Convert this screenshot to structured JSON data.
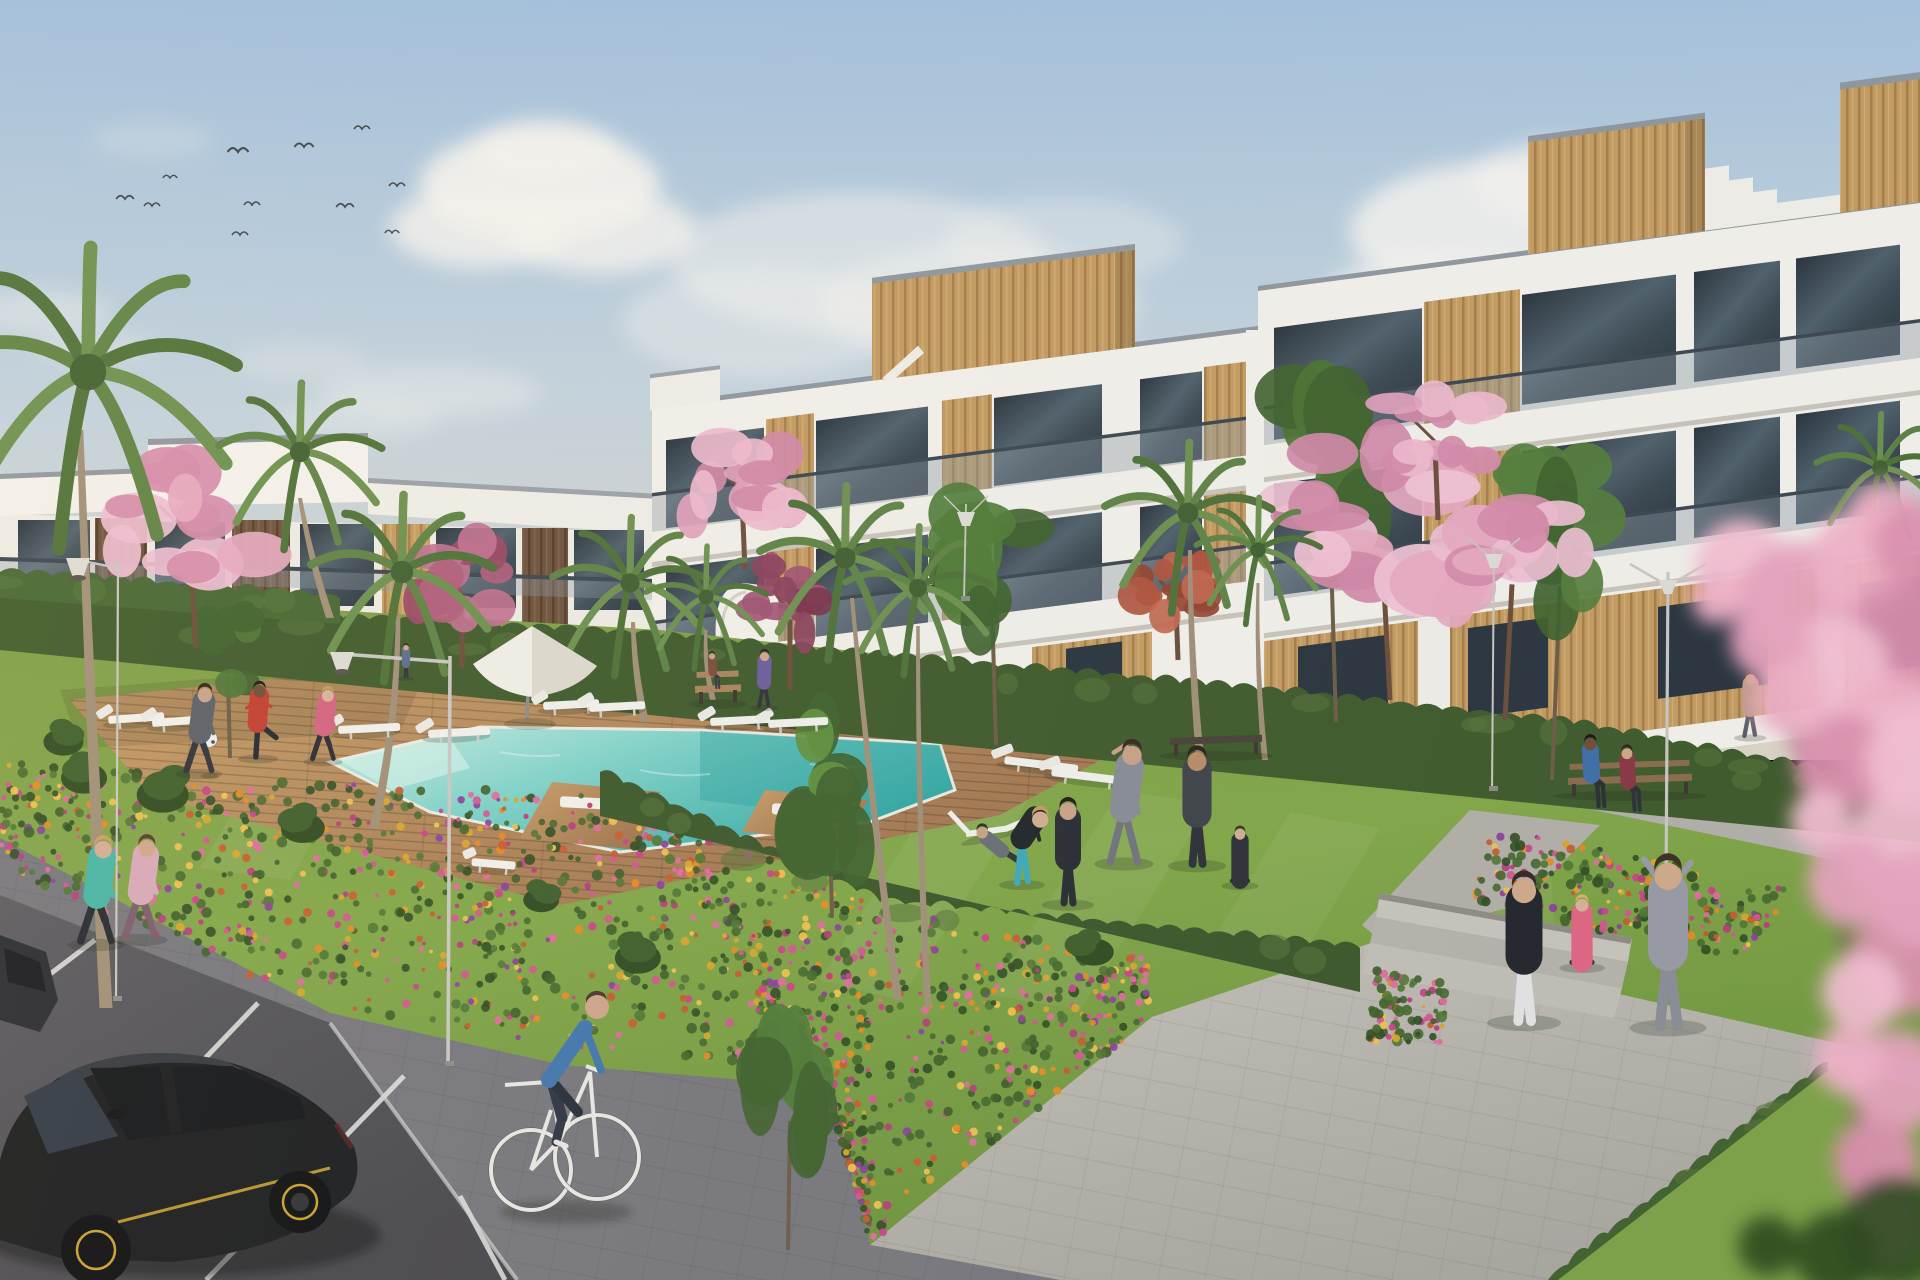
{
  "meta": {
    "scene": "residential-complex-3d-render",
    "style": "architectural visualization, golden afternoon light"
  },
  "labels": {
    "scene": "3D render of a modern white apartment complex with communal pool garden",
    "sky": "pale blue sky with soft clouds and a flock of birds",
    "buildings": "white three-storey apartments with wood cladding and glass balconies",
    "pool": "turquoise swimming pool with wooden deck and sun loungers",
    "lawn": "bright green communal lawn with people exercising",
    "road": "asphalt parking strip with black hatchback car",
    "foreground": "out-of-focus pink blossom branch"
  },
  "palette": {
    "sky_top": "#9dbddc",
    "sky_mid": "#c3d2dc",
    "sky_horizon": "#ddd5c6",
    "cloud": "#f7f4ef",
    "building_white": "#f4f1ea",
    "building_shadow": "#d9d5cc",
    "window_glass": "#31404c",
    "wood_gold": "#c49a5e",
    "wood_dark": "#5f4734",
    "balcony_glass": "#8b98a2",
    "hedge_green": "#3f5a28",
    "lawn_light": "#8fae4d",
    "lawn_dark": "#6d9339",
    "pool_light": "#bfe9df",
    "pool_deep": "#2fa8a4",
    "deck_wood": "#b98a58",
    "path_gray": "#b7b3aa",
    "sidewalk_gray": "#76757a",
    "road_gray": "#4e4d52",
    "flower_orange": "#e8891f",
    "flower_magenta": "#cc3f88",
    "flower_purple": "#8a3f9a",
    "flower_gold": "#d9a42a",
    "blossom_pink": "#e8a8bf",
    "car_black": "#17181a",
    "car_accent_yellow": "#c9a22c"
  },
  "clouds": [
    [
      540,
      185,
      120,
      55,
      0.9
    ],
    [
      480,
      228,
      90,
      40,
      0.8
    ],
    [
      602,
      232,
      95,
      42,
      0.8
    ],
    [
      545,
      152,
      70,
      32,
      0.7
    ],
    [
      860,
      262,
      190,
      70,
      0.5
    ],
    [
      980,
      305,
      160,
      60,
      0.45
    ],
    [
      762,
      322,
      140,
      55,
      0.4
    ],
    [
      1062,
      242,
      120,
      45,
      0.35
    ],
    [
      1500,
      232,
      150,
      70,
      0.85
    ],
    [
      1432,
      302,
      110,
      50,
      0.7
    ],
    [
      1562,
      182,
      90,
      40,
      0.75
    ],
    [
      430,
      392,
      110,
      26,
      0.38
    ],
    [
      358,
      420,
      82,
      20,
      0.3
    ],
    [
      300,
      362,
      70,
      18,
      0.26
    ],
    [
      40,
      312,
      70,
      22,
      0.38
    ],
    [
      92,
      346,
      60,
      16,
      0.3
    ],
    [
      152,
      140,
      62,
      18,
      0.22
    ],
    [
      1180,
      380,
      120,
      28,
      0.25
    ]
  ],
  "birds": [
    [
      125,
      199,
      1.1
    ],
    [
      152,
      206,
      1.0
    ],
    [
      170,
      178,
      0.9
    ],
    [
      238,
      152,
      1.3
    ],
    [
      240,
      235,
      1.0
    ],
    [
      252,
      205,
      1.0
    ],
    [
      304,
      147,
      1.2
    ],
    [
      345,
      207,
      1.1
    ],
    [
      362,
      129,
      1.0
    ],
    [
      397,
      186,
      1.0
    ],
    [
      392,
      233,
      0.9
    ]
  ],
  "mow_stripes": [
    [
      [
        950,
        770
      ],
      [
        1040,
        782
      ],
      [
        900,
        1000
      ],
      [
        820,
        980
      ]
    ],
    [
      [
        1120,
        790
      ],
      [
        1210,
        804
      ],
      [
        1080,
        1010
      ],
      [
        990,
        995
      ]
    ],
    [
      [
        1290,
        812
      ],
      [
        1380,
        828
      ],
      [
        1300,
        960
      ],
      [
        1210,
        945
      ]
    ],
    [
      [
        1460,
        840
      ],
      [
        1550,
        858
      ],
      [
        1560,
        1010
      ],
      [
        1470,
        995
      ]
    ],
    [
      [
        240,
        800
      ],
      [
        330,
        812
      ],
      [
        290,
        880
      ],
      [
        200,
        868
      ]
    ]
  ],
  "beds": [
    {
      "q": [
        [
          0,
          762
        ],
        [
          320,
          782
        ],
        [
          330,
          1010
        ],
        [
          0,
          868
        ]
      ],
      "n": 300
    },
    {
      "q": [
        [
          320,
          782
        ],
        [
          620,
          795
        ],
        [
          830,
          1086
        ],
        [
          330,
          1010
        ]
      ],
      "n": 460
    },
    {
      "q": [
        [
          620,
          795
        ],
        [
          880,
          905
        ],
        [
          870,
          1243
        ],
        [
          830,
          1086
        ]
      ],
      "n": 420
    },
    {
      "q": [
        [
          880,
          905
        ],
        [
          1150,
          958
        ],
        [
          1152,
          1017
        ],
        [
          870,
          1243
        ]
      ],
      "n": 330
    },
    {
      "q": [
        [
          1376,
          970
        ],
        [
          1452,
          985
        ],
        [
          1438,
          1055
        ],
        [
          1366,
          1040
        ]
      ],
      "n": 90
    },
    {
      "q": [
        [
          1490,
          826
        ],
        [
          1802,
          892
        ],
        [
          1742,
          960
        ],
        [
          1468,
          902
        ]
      ],
      "n": 240
    }
  ],
  "flower_colors": [
    "#e8891f",
    "#d9a42a",
    "#cc3f88",
    "#e06a9a",
    "#8a3f9a",
    "#c85a2a",
    "#f0c04a",
    "#b83a78",
    "#d4548e"
  ],
  "leaf_colors": [
    "#2e4a1e",
    "#3c5c26",
    "#4e7430",
    "#446628"
  ],
  "hedges": [
    {
      "pts": [
        [
          0,
          598
        ],
        [
          660,
          636
        ],
        [
          1258,
          690
        ],
        [
          1574,
          724
        ],
        [
          1920,
          790
        ]
      ],
      "h": 52,
      "c": "#3d5827"
    },
    {
      "pts": [
        [
          600,
          772
        ],
        [
          880,
          902
        ],
        [
          1360,
          948
        ]
      ],
      "h": 44,
      "c": "#3a5526"
    },
    {
      "pts": [
        [
          1828,
          1062
        ],
        [
          1548,
          1280
        ]
      ],
      "h": 40,
      "c": "#41602b"
    },
    {
      "pts": [
        [
          0,
          572
        ],
        [
          340,
          598
        ]
      ],
      "h": 26,
      "c": "#44642e"
    }
  ],
  "palms": [
    {
      "cx": 88,
      "cy": 372,
      "r": 152,
      "top": [
        80,
        430
      ],
      "base": [
        106,
        1008
      ],
      "w": 13
    },
    {
      "cx": 300,
      "cy": 452,
      "r": 84,
      "top": [
        300,
        498
      ],
      "base": [
        330,
        618
      ],
      "w": 8
    },
    {
      "cx": 402,
      "cy": 572,
      "r": 94,
      "top": [
        398,
        616
      ],
      "base": [
        374,
        828
      ],
      "w": 9
    },
    {
      "cx": 630,
      "cy": 583,
      "r": 80,
      "top": [
        633,
        622
      ],
      "base": [
        645,
        722
      ],
      "w": 8
    },
    {
      "cx": 706,
      "cy": 597,
      "r": 62,
      "top": [
        706,
        630
      ],
      "base": [
        713,
        700
      ],
      "w": 6
    },
    {
      "cx": 845,
      "cy": 558,
      "r": 88,
      "top": [
        852,
        598
      ],
      "base": [
        898,
        1000
      ],
      "w": 8
    },
    {
      "cx": 918,
      "cy": 588,
      "r": 75,
      "top": [
        918,
        626
      ],
      "base": [
        928,
        1008
      ],
      "w": 7
    },
    {
      "cx": 1188,
      "cy": 513,
      "r": 86,
      "top": [
        1190,
        550
      ],
      "base": [
        1200,
        758
      ],
      "w": 8
    },
    {
      "cx": 1258,
      "cy": 550,
      "r": 64,
      "top": [
        1258,
        583
      ],
      "base": [
        1265,
        760
      ],
      "w": 6
    },
    {
      "cx": 1880,
      "cy": 468,
      "r": 66,
      "top": [
        1878,
        498
      ],
      "base": [
        1886,
        562
      ],
      "w": 6
    }
  ],
  "greens": [
    {
      "cx": 992,
      "cy": 560,
      "rx": 58,
      "ry": 88,
      "base": [
        996,
        745
      ],
      "c": "#4e7a33"
    },
    {
      "cx": 1330,
      "cy": 468,
      "rx": 62,
      "ry": 112,
      "base": [
        1336,
        722
      ],
      "c": "#48722e"
    },
    {
      "cx": 1560,
      "cy": 538,
      "rx": 58,
      "ry": 96,
      "base": [
        1552,
        780
      ],
      "c": "#527c36"
    },
    {
      "cx": 830,
      "cy": 788,
      "rx": 55,
      "ry": 92,
      "base": [
        832,
        918
      ],
      "c": "#5f8f3a"
    },
    {
      "cx": 790,
      "cy": 1062,
      "rx": 46,
      "ry": 118,
      "base": [
        788,
        1250
      ],
      "c": "#4e7a33"
    },
    {
      "cx": 228,
      "cy": 652,
      "rx": 32,
      "ry": 48,
      "base": [
        230,
        758
      ],
      "c": "#4c7431"
    }
  ],
  "blossoms": [
    {
      "cx": 190,
      "cy": 518,
      "rx": 76,
      "ry": 62,
      "base": [
        196,
        648
      ],
      "c1": "#e8a8bf",
      "c2": "#d68aa8",
      "c3": "#f0bdd0"
    },
    {
      "cx": 462,
      "cy": 578,
      "rx": 52,
      "ry": 50,
      "base": [
        462,
        668
      ],
      "c1": "#b05a78",
      "c2": "#9a4462",
      "c3": "#c06e8c"
    },
    {
      "cx": 742,
      "cy": 476,
      "rx": 60,
      "ry": 56,
      "base": [
        745,
        570
      ],
      "c1": "#e3a0ba",
      "c2": "#d287a5",
      "c3": "#efb8cc"
    },
    {
      "cx": 790,
      "cy": 600,
      "rx": 42,
      "ry": 48,
      "base": [
        790,
        690
      ],
      "c1": "#8a3e58",
      "c2": "#7a3048",
      "c3": "#a05070"
    },
    {
      "cx": 1176,
      "cy": 588,
      "rx": 42,
      "ry": 42,
      "base": [
        1178,
        660
      ],
      "c1": "#b05038",
      "c2": "#94402c",
      "c3": "#c2644a"
    },
    {
      "cx": 1382,
      "cy": 518,
      "rx": 96,
      "ry": 82,
      "base": [
        1390,
        700
      ],
      "c1": "#e8a8bf",
      "c2": "#d287a5",
      "c3": "#f2c2d4"
    },
    {
      "cx": 1435,
      "cy": 428,
      "rx": 56,
      "ry": 44,
      "base": [
        1438,
        520
      ],
      "c1": "#e3a0ba",
      "c2": "#d68aa8",
      "c3": "#efb8cc"
    },
    {
      "cx": 1512,
      "cy": 558,
      "rx": 72,
      "ry": 66,
      "base": [
        1505,
        720
      ],
      "c1": "#e8a8bf",
      "c2": "#d68aa8",
      "c3": "#f0bdd0"
    }
  ],
  "shrubs": [
    [
      62,
      742,
      40
    ],
    [
      88,
      778,
      46
    ],
    [
      168,
      795,
      52
    ],
    [
      300,
      828,
      44
    ],
    [
      640,
      958,
      46
    ],
    [
      1088,
      952,
      40
    ],
    [
      540,
      900,
      36
    ]
  ],
  "lamps": [
    {
      "x": 118,
      "top": 562,
      "base": 1000,
      "kind": "cone",
      "dir": -1,
      "arm": 40,
      "w": 2.2
    },
    {
      "x": 450,
      "top": 656,
      "base": 1065,
      "kind": "cone",
      "dir": -1,
      "arm": 108,
      "w": 3.6
    },
    {
      "x": 1668,
      "top": 572,
      "base": 888,
      "kind": "v",
      "dir": 1,
      "arm": 38,
      "w": 3.2
    },
    {
      "x": 1494,
      "top": 546,
      "base": 790,
      "kind": "v",
      "dir": 1,
      "arm": 26,
      "w": 2.0
    },
    {
      "x": 966,
      "top": 504,
      "base": 600,
      "kind": "v",
      "dir": 1,
      "arm": 22,
      "w": 1.8
    }
  ],
  "benches": [
    {
      "x": 695,
      "y": 688,
      "w": 46,
      "type": "back",
      "c": "#a8845a"
    },
    {
      "x": 1170,
      "y": 740,
      "w": 92,
      "type": "backless",
      "c": "#473f33"
    },
    {
      "x": 1568,
      "y": 780,
      "w": 124,
      "type": "back",
      "c": "#8a6a48"
    }
  ],
  "loungers": [
    {
      "x": 108,
      "y": 716,
      "w": 56,
      "a": -4
    },
    {
      "x": 152,
      "y": 719,
      "w": 56,
      "a": -4
    },
    {
      "x": 338,
      "y": 726,
      "w": 62,
      "a": -3
    },
    {
      "x": 428,
      "y": 730,
      "w": 62,
      "a": -3
    },
    {
      "x": 543,
      "y": 702,
      "w": 56,
      "a": -3
    },
    {
      "x": 589,
      "y": 704,
      "w": 56,
      "a": -3
    },
    {
      "x": 710,
      "y": 718,
      "w": 60,
      "a": -3
    },
    {
      "x": 768,
      "y": 720,
      "w": 60,
      "a": -3
    },
    {
      "x": 1005,
      "y": 756,
      "w": 74,
      "a": 7
    },
    {
      "x": 1052,
      "y": 768,
      "w": 74,
      "a": 7
    },
    {
      "x": 472,
      "y": 858,
      "w": 44,
      "a": 5,
      "type": "chair"
    },
    {
      "x": 966,
      "y": 834,
      "w": 74,
      "a": -16,
      "type": "deckchair"
    }
  ],
  "people": [
    {
      "name": "footballer-gray",
      "x": 199,
      "y": 772,
      "h": 84,
      "shirt": "#595d66",
      "pants": "#2c2f36",
      "skin": "#c9a184",
      "hair": "#2a2118",
      "pose": "run"
    },
    {
      "name": "footballer-red",
      "x": 258,
      "y": 757,
      "h": 72,
      "shirt": "#c23a2c",
      "pants": "#22252b",
      "skin": "#6f4a33",
      "hair": "#1c140e",
      "pose": "kick"
    },
    {
      "name": "footballer-pink",
      "x": 323,
      "y": 760,
      "h": 70,
      "shirt": "#d4607e",
      "pants": "#26282e",
      "skin": "#d8b298",
      "hair": "#c79a54",
      "pose": "run"
    },
    {
      "name": "jogger-teal",
      "x": 96,
      "y": 943,
      "h": 102,
      "shirt": "#45b4a4",
      "pants": "#23262c",
      "skin": "#d4ac90",
      "hair": "#c9a058",
      "pose": "run"
    },
    {
      "name": "jogger-pink",
      "x": 140,
      "y": 938,
      "h": 98,
      "shirt": "#d8a8b6",
      "pants": "#785a68",
      "skin": "#d0a686",
      "hair": "#55382a",
      "pose": "run"
    },
    {
      "name": "man-deckchair",
      "x": 1000,
      "y": 860,
      "h": 66,
      "shirt": "#686c74",
      "pants": "#2c3036",
      "skin": "#c9a184",
      "hair": "#2f251c",
      "pose": "recline"
    },
    {
      "name": "woman-teal-leggings",
      "x": 1022,
      "y": 883,
      "h": 96,
      "shirt": "#1e2126",
      "pants": "#3aa8b8",
      "skin": "#d4ac90",
      "hair": "#c59a58",
      "pose": "bent"
    },
    {
      "name": "person-tracksuit",
      "x": 1068,
      "y": 903,
      "h": 100,
      "shirt": "#26282e",
      "pants": "#26282e",
      "skin": "#caa286",
      "hair": "#1e1710",
      "pose": "stand"
    },
    {
      "name": "man-stretching",
      "x": 1124,
      "y": 862,
      "h": 114,
      "shirt": "#878b93",
      "pants": "#70727a",
      "skin": "#c9a184",
      "hair": "#332619",
      "pose": "stretch"
    },
    {
      "name": "man-shorts",
      "x": 1197,
      "y": 864,
      "h": 112,
      "shirt": "#3c4046",
      "pants": "#2a2e33",
      "skin": "#b88a64",
      "hair": "#2a1f16",
      "pose": "stand"
    },
    {
      "name": "woman-crosslegged",
      "x": 1240,
      "y": 884,
      "h": 62,
      "shirt": "#2b2d33",
      "pants": "#26282e",
      "skin": "#d4ac90",
      "hair": "#3a2c20",
      "pose": "sitcross"
    },
    {
      "name": "bench-man",
      "x": 1598,
      "y": 806,
      "h": 70,
      "shirt": "#3e6ca4",
      "pants": "#282b31",
      "skin": "#6f4a33",
      "hair": "#15100c",
      "pose": "sit"
    },
    {
      "name": "bench-woman",
      "x": 1634,
      "y": 810,
      "h": 64,
      "shirt": "#8a3440",
      "pants": "#2a2d33",
      "skin": "#d0a686",
      "hair": "#2e2019",
      "pose": "sit"
    },
    {
      "name": "woman-standing-white-leggings",
      "x": 1524,
      "y": 1021,
      "h": 142,
      "shirt": "#202227",
      "pants": "#e6e4e2",
      "skin": "#d2a888",
      "hair": "#33241a",
      "pose": "stand"
    },
    {
      "name": "woman-sitting-pink",
      "x": 1582,
      "y": 966,
      "h": 76,
      "shirt": "#e2637e",
      "pants": "#26282e",
      "skin": "#d8b096",
      "hair": "#d8b060",
      "pose": "sitcross"
    },
    {
      "name": "woman-hoodie-armsup",
      "x": 1668,
      "y": 1026,
      "h": 160,
      "shirt": "#989aa2",
      "pants": "#8a8c94",
      "skin": "#d2a888",
      "hair": "#3a2c20",
      "pose": "armsup"
    },
    {
      "name": "walker-small",
      "x": 764,
      "y": 706,
      "h": 54,
      "shirt": "#6a5a9a",
      "pants": "#2c2e34",
      "skin": "#d0a686",
      "hair": "#2e2019",
      "pose": "walk"
    },
    {
      "name": "walker-right",
      "x": 1750,
      "y": 736,
      "h": 62,
      "shirt": "#c29a86",
      "pants": "#585a64",
      "skin": "#d0a686",
      "hair": "#4a3426",
      "pose": "walk"
    },
    {
      "name": "sitter-small",
      "x": 716,
      "y": 688,
      "h": 36,
      "shirt": "#7a4a3a",
      "pants": "#33363c",
      "skin": "#caa286",
      "hair": "#2a1f16",
      "pose": "sit"
    },
    {
      "name": "terrace-person",
      "x": 406,
      "y": 677,
      "h": 32,
      "shirt": "#5a6a8a",
      "pants": "#2c2e34",
      "skin": "#d0a686",
      "hair": "#2e2019",
      "pose": "stand"
    }
  ],
  "fg_blossom": {
    "pink": [
      [
        1742,
        565,
        46
      ],
      [
        1800,
        600,
        58
      ],
      [
        1862,
        560,
        50
      ],
      [
        1908,
        640,
        62
      ],
      [
        1836,
        668,
        52
      ],
      [
        1770,
        640,
        40
      ],
      [
        1896,
        740,
        64
      ],
      [
        1842,
        762,
        48
      ],
      [
        1902,
        850,
        58
      ],
      [
        1852,
        882,
        44
      ],
      [
        1790,
        700,
        36
      ],
      [
        1906,
        960,
        54
      ],
      [
        1862,
        992,
        40
      ],
      [
        1898,
        1080,
        50
      ],
      [
        1848,
        1060,
        34
      ],
      [
        1876,
        1160,
        42
      ],
      [
        1820,
        820,
        30
      ],
      [
        1768,
        588,
        28
      ],
      [
        1884,
        518,
        36
      ],
      [
        1916,
        544,
        42
      ],
      [
        1918,
        760,
        52
      ],
      [
        1918,
        900,
        48
      ],
      [
        1716,
        600,
        24
      ],
      [
        1884,
        1228,
        40
      ]
    ],
    "green": [
      [
        1896,
        1232,
        56
      ],
      [
        1836,
        1254,
        42
      ],
      [
        1768,
        1246,
        30
      ]
    ]
  }
}
